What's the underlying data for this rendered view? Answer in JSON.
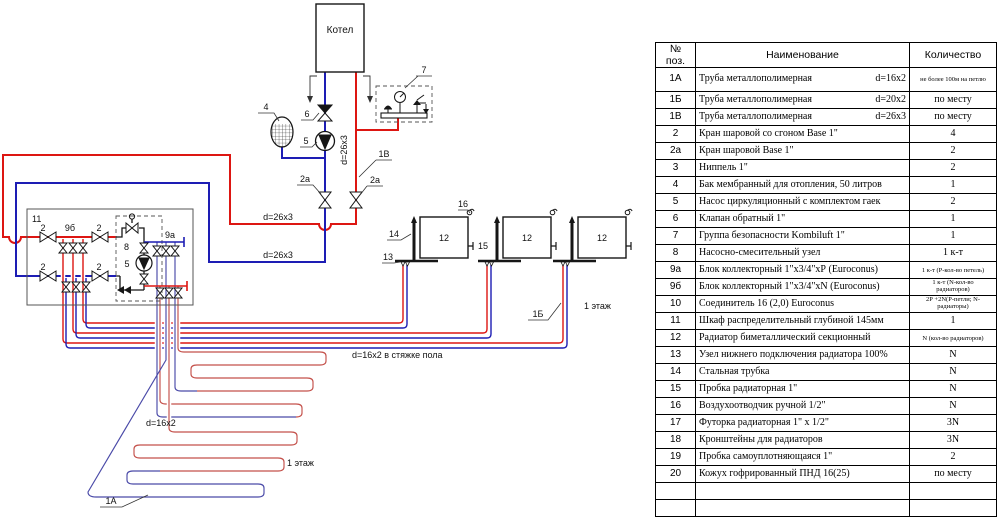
{
  "colors": {
    "supply": "#dd1612",
    "return": "#1d1db4",
    "serp-supply": "#c4504a",
    "serp-return": "#4a4aa8",
    "ink": "#161616"
  },
  "diagram": {
    "labels": {
      "kotel": "Котел",
      "p2": "2",
      "p2a": "2а",
      "p4": "4",
      "p5": "5",
      "p6": "6",
      "p7": "7",
      "p8": "8",
      "p9a": "9а",
      "p9b": "9б",
      "p11": "11",
      "p12": "12",
      "p13": "13",
      "p14": "14",
      "p15": "15",
      "p16": "16",
      "l1A": "1А",
      "l1B": "1Б",
      "l1V": "1В",
      "d26": "d=26x3",
      "d16floor": "d=16x2 в стяжке пола",
      "d16": "d=16x2",
      "floor1": "1 этаж"
    }
  },
  "table": {
    "headers": [
      "№ поз.",
      "Наименование",
      "Количество"
    ],
    "rows": [
      {
        "pos": "1А",
        "name": "Труба металлополимерная",
        "size": "d=16x2",
        "qty": "не более 100м на петлю",
        "small": true,
        "tall": true
      },
      {
        "pos": "1Б",
        "name": "Труба металлополимерная",
        "size": "d=20x2",
        "qty": "по месту"
      },
      {
        "pos": "1В",
        "name": "Труба металлополимерная",
        "size": "d=26x3",
        "qty": "по месту"
      },
      {
        "pos": "2",
        "name": "Кран шаровой  со сгоном Base 1\"",
        "qty": "4"
      },
      {
        "pos": "2а",
        "name": "Кран шаровой   Base 1\"",
        "qty": "2"
      },
      {
        "pos": "3",
        "name": "Ниппель 1\"",
        "qty": "2"
      },
      {
        "pos": "4",
        "name": "Бак  мембранный для отопления,  50 литров",
        "qty": "1"
      },
      {
        "pos": "5",
        "name": "Насос циркуляционный с комплектом гаек",
        "qty": "2"
      },
      {
        "pos": "6",
        "name": "Клапан обратный   1\"",
        "qty": "1"
      },
      {
        "pos": "7",
        "name": "Группа безопасности Kombiluft  1\"",
        "qty": "1"
      },
      {
        "pos": "8",
        "name": "Насосно-смесительный узел",
        "qty": "1 к-т"
      },
      {
        "pos": "9а",
        "name": "Блок коллекторный  1\"х3/4\"хР (Euroconus)",
        "qty": "1 к-т  (Р-кол-во петель)",
        "small": true
      },
      {
        "pos": "9б",
        "name": "Блок коллекторный  1\"х3/4\"хN (Euroconus)",
        "qty": "1 к-т  (N-кол-во радиаторов)",
        "small": true
      },
      {
        "pos": "10",
        "name": "Соединитель 16 (2,0) Eurocоnus",
        "qty": "2Р +2N(Р-петли; N-радиаторы)",
        "small": true
      },
      {
        "pos": "11",
        "name": "Шкаф распределительный  глубиной 145мм",
        "qty": "1"
      },
      {
        "pos": "12",
        "name": "Радиатор биметаллический секционный",
        "qty": "N (кол-во радиаторов)",
        "small": true
      },
      {
        "pos": "13",
        "name": "Узел нижнего подключения радиатора 100%",
        "qty": "N"
      },
      {
        "pos": "14",
        "name": "Стальная трубка",
        "qty": "N"
      },
      {
        "pos": "15",
        "name": "Пробка радиаторная  1\"",
        "qty": "N"
      },
      {
        "pos": "16",
        "name": "Воздухоотводчик ручной  1/2\"",
        "qty": "N"
      },
      {
        "pos": "17",
        "name": "Футорка радиаторная  1\" х 1/2\"",
        "qty": "3N"
      },
      {
        "pos": "18",
        "name": "Кронштейны для радиаторов",
        "qty": "3N"
      },
      {
        "pos": "19",
        "name": "Пробка самоуплотняющаяся  1\"",
        "qty": "2"
      },
      {
        "pos": "20",
        "name": "Кожух гофрированный ПНД 16(25)",
        "qty": "по месту"
      },
      {
        "pos": "",
        "name": "",
        "qty": ""
      },
      {
        "pos": "",
        "name": "",
        "qty": ""
      }
    ]
  }
}
